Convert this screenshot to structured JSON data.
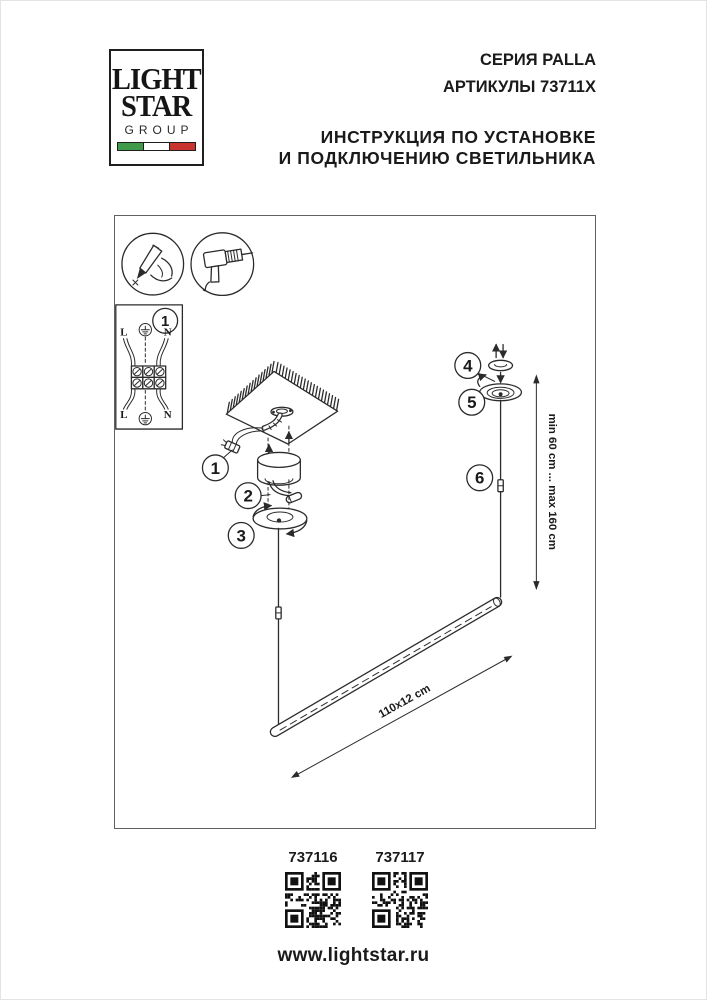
{
  "header": {
    "logo": {
      "word1": "LIGHT",
      "word2": "STAR",
      "word3": "GROUP",
      "flag_green": "#3f9b4a",
      "flag_white": "#ffffff",
      "flag_red": "#c9342e"
    },
    "series": "СЕРИЯ PALLA",
    "articles": "АРТИКУЛЫ 73711X",
    "instruction_line1": "ИНСТРУКЦИЯ ПО УСТАНОВКЕ",
    "instruction_line2": "И ПОДКЛЮЧЕНИЮ СВЕТИЛЬНИКА"
  },
  "diagram": {
    "tool_icons": [
      "marking-pencil",
      "drill"
    ],
    "steps": [
      "1",
      "2",
      "3",
      "4",
      "5",
      "6"
    ],
    "wiring": {
      "step": "1",
      "l_top": "L",
      "n_top": "N",
      "l_bottom": "L",
      "n_bottom": "N"
    },
    "dimensions": {
      "suspension": "min 60 cm ... max 160 cm",
      "bar": "110x12 cm"
    },
    "line_color": "#2b2b2b"
  },
  "footer": {
    "qr": [
      {
        "label": "737116"
      },
      {
        "label": "737117"
      }
    ],
    "website": "www.lightstar.ru"
  }
}
